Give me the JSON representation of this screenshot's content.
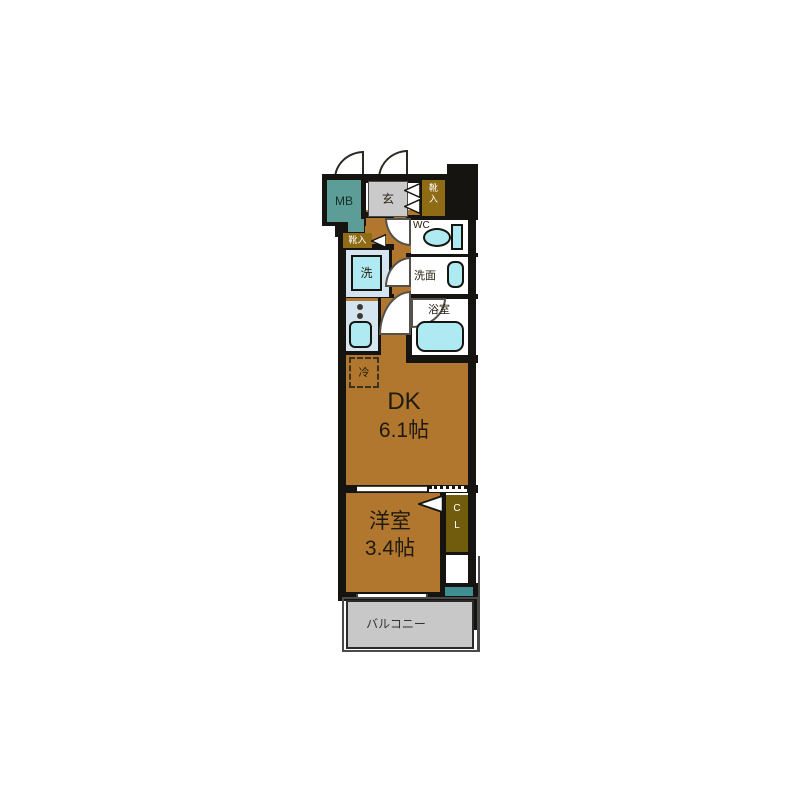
{
  "title": "apartment-floor-plan",
  "colors": {
    "floor": "#B1772E",
    "wall": "#161410",
    "teal": "#5C9D97",
    "teal_dark": "#3E8E92",
    "shoe": "#8F6B15",
    "closet": "#715C0E",
    "genkan": "#CACACA",
    "balcony": "#C8C8C8",
    "fixture_bg": "#D5E4F1",
    "fixture": "#AFEAF2",
    "room": "#FFFFFF"
  },
  "rooms": {
    "meter_box": {
      "label": "MB"
    },
    "entrance": {
      "label": "玄"
    },
    "shoe_cabinet_upper": {
      "label": "靴入"
    },
    "shoe_cabinet_lower": {
      "label": "靴入"
    },
    "toilet": {
      "label": "WC"
    },
    "washer": {
      "label": "洗"
    },
    "washroom": {
      "label": "洗面"
    },
    "bathroom": {
      "label": "浴室"
    },
    "fridge_space": {
      "label": "冷"
    },
    "dining_kitchen": {
      "name": "DK",
      "size": "6.1帖"
    },
    "western_room": {
      "name": "洋室",
      "size": "3.4帖"
    },
    "closet": {
      "label": "CL"
    },
    "balcony": {
      "label": "バルコニー"
    }
  }
}
